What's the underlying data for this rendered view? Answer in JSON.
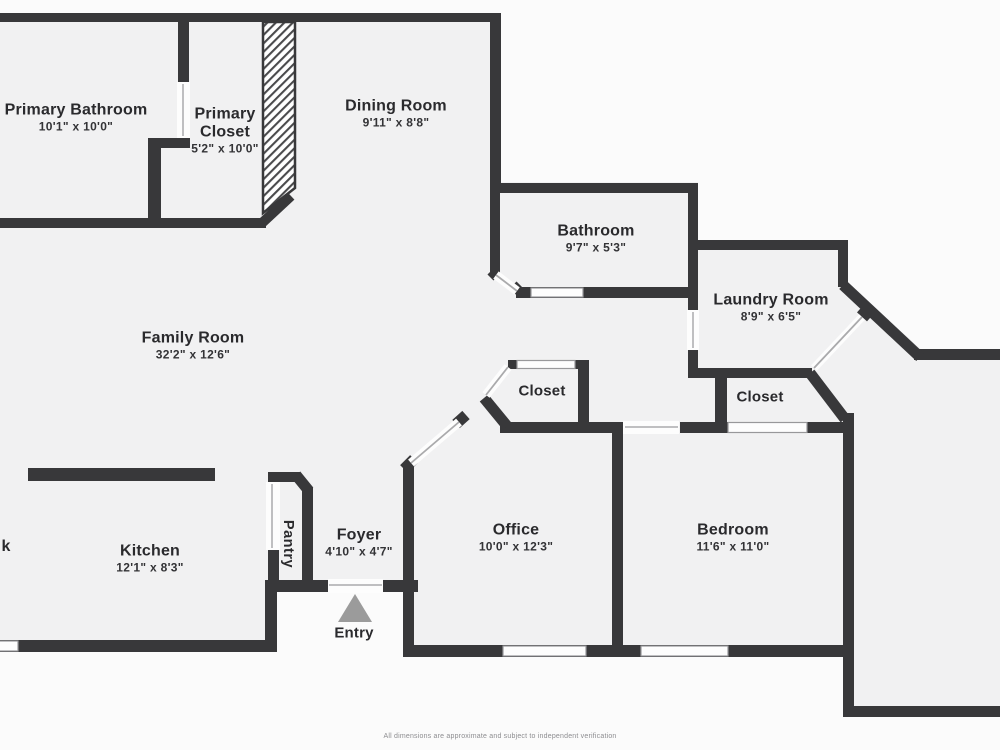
{
  "plan": {
    "rooms": [
      {
        "id": "primary-bathroom",
        "name": "Primary Bathroom",
        "dims": "10'1\" x 10'0\""
      },
      {
        "id": "primary-closet",
        "name": "Primary Closet",
        "dims": "5'2\" x 10'0\""
      },
      {
        "id": "dining-room",
        "name": "Dining Room",
        "dims": "9'11\" x 8'8\""
      },
      {
        "id": "bathroom",
        "name": "Bathroom",
        "dims": "9'7\" x 5'3\""
      },
      {
        "id": "laundry-room",
        "name": "Laundry Room",
        "dims": "8'9\" x 6'5\""
      },
      {
        "id": "family-room",
        "name": "Family Room",
        "dims": "32'2\" x 12'6\""
      },
      {
        "id": "hall-closet",
        "name": "Closet"
      },
      {
        "id": "bedroom-closet",
        "name": "Closet"
      },
      {
        "id": "office",
        "name": "Office",
        "dims": "10'0\" x 12'3\""
      },
      {
        "id": "bedroom",
        "name": "Bedroom",
        "dims": "11'6\" x 11'0\""
      },
      {
        "id": "kitchen",
        "name": "Kitchen",
        "dims": "12'1\" x 8'3\""
      },
      {
        "id": "foyer",
        "name": "Foyer",
        "dims": "4'10\" x 4'7\""
      },
      {
        "id": "pantry",
        "name": "Pantry"
      },
      {
        "id": "entry",
        "name": "Entry"
      },
      {
        "id": "cutoff-room-partial",
        "name": "k"
      }
    ],
    "footer": "All dimensions are approximate and subject to independent verification",
    "colors": {
      "wall": "#38383a",
      "floor": "#f1f1f2",
      "background": "#fbfbfb",
      "entry_arrow": "#9b9b9b",
      "door_line": "#bfbfc1"
    }
  }
}
